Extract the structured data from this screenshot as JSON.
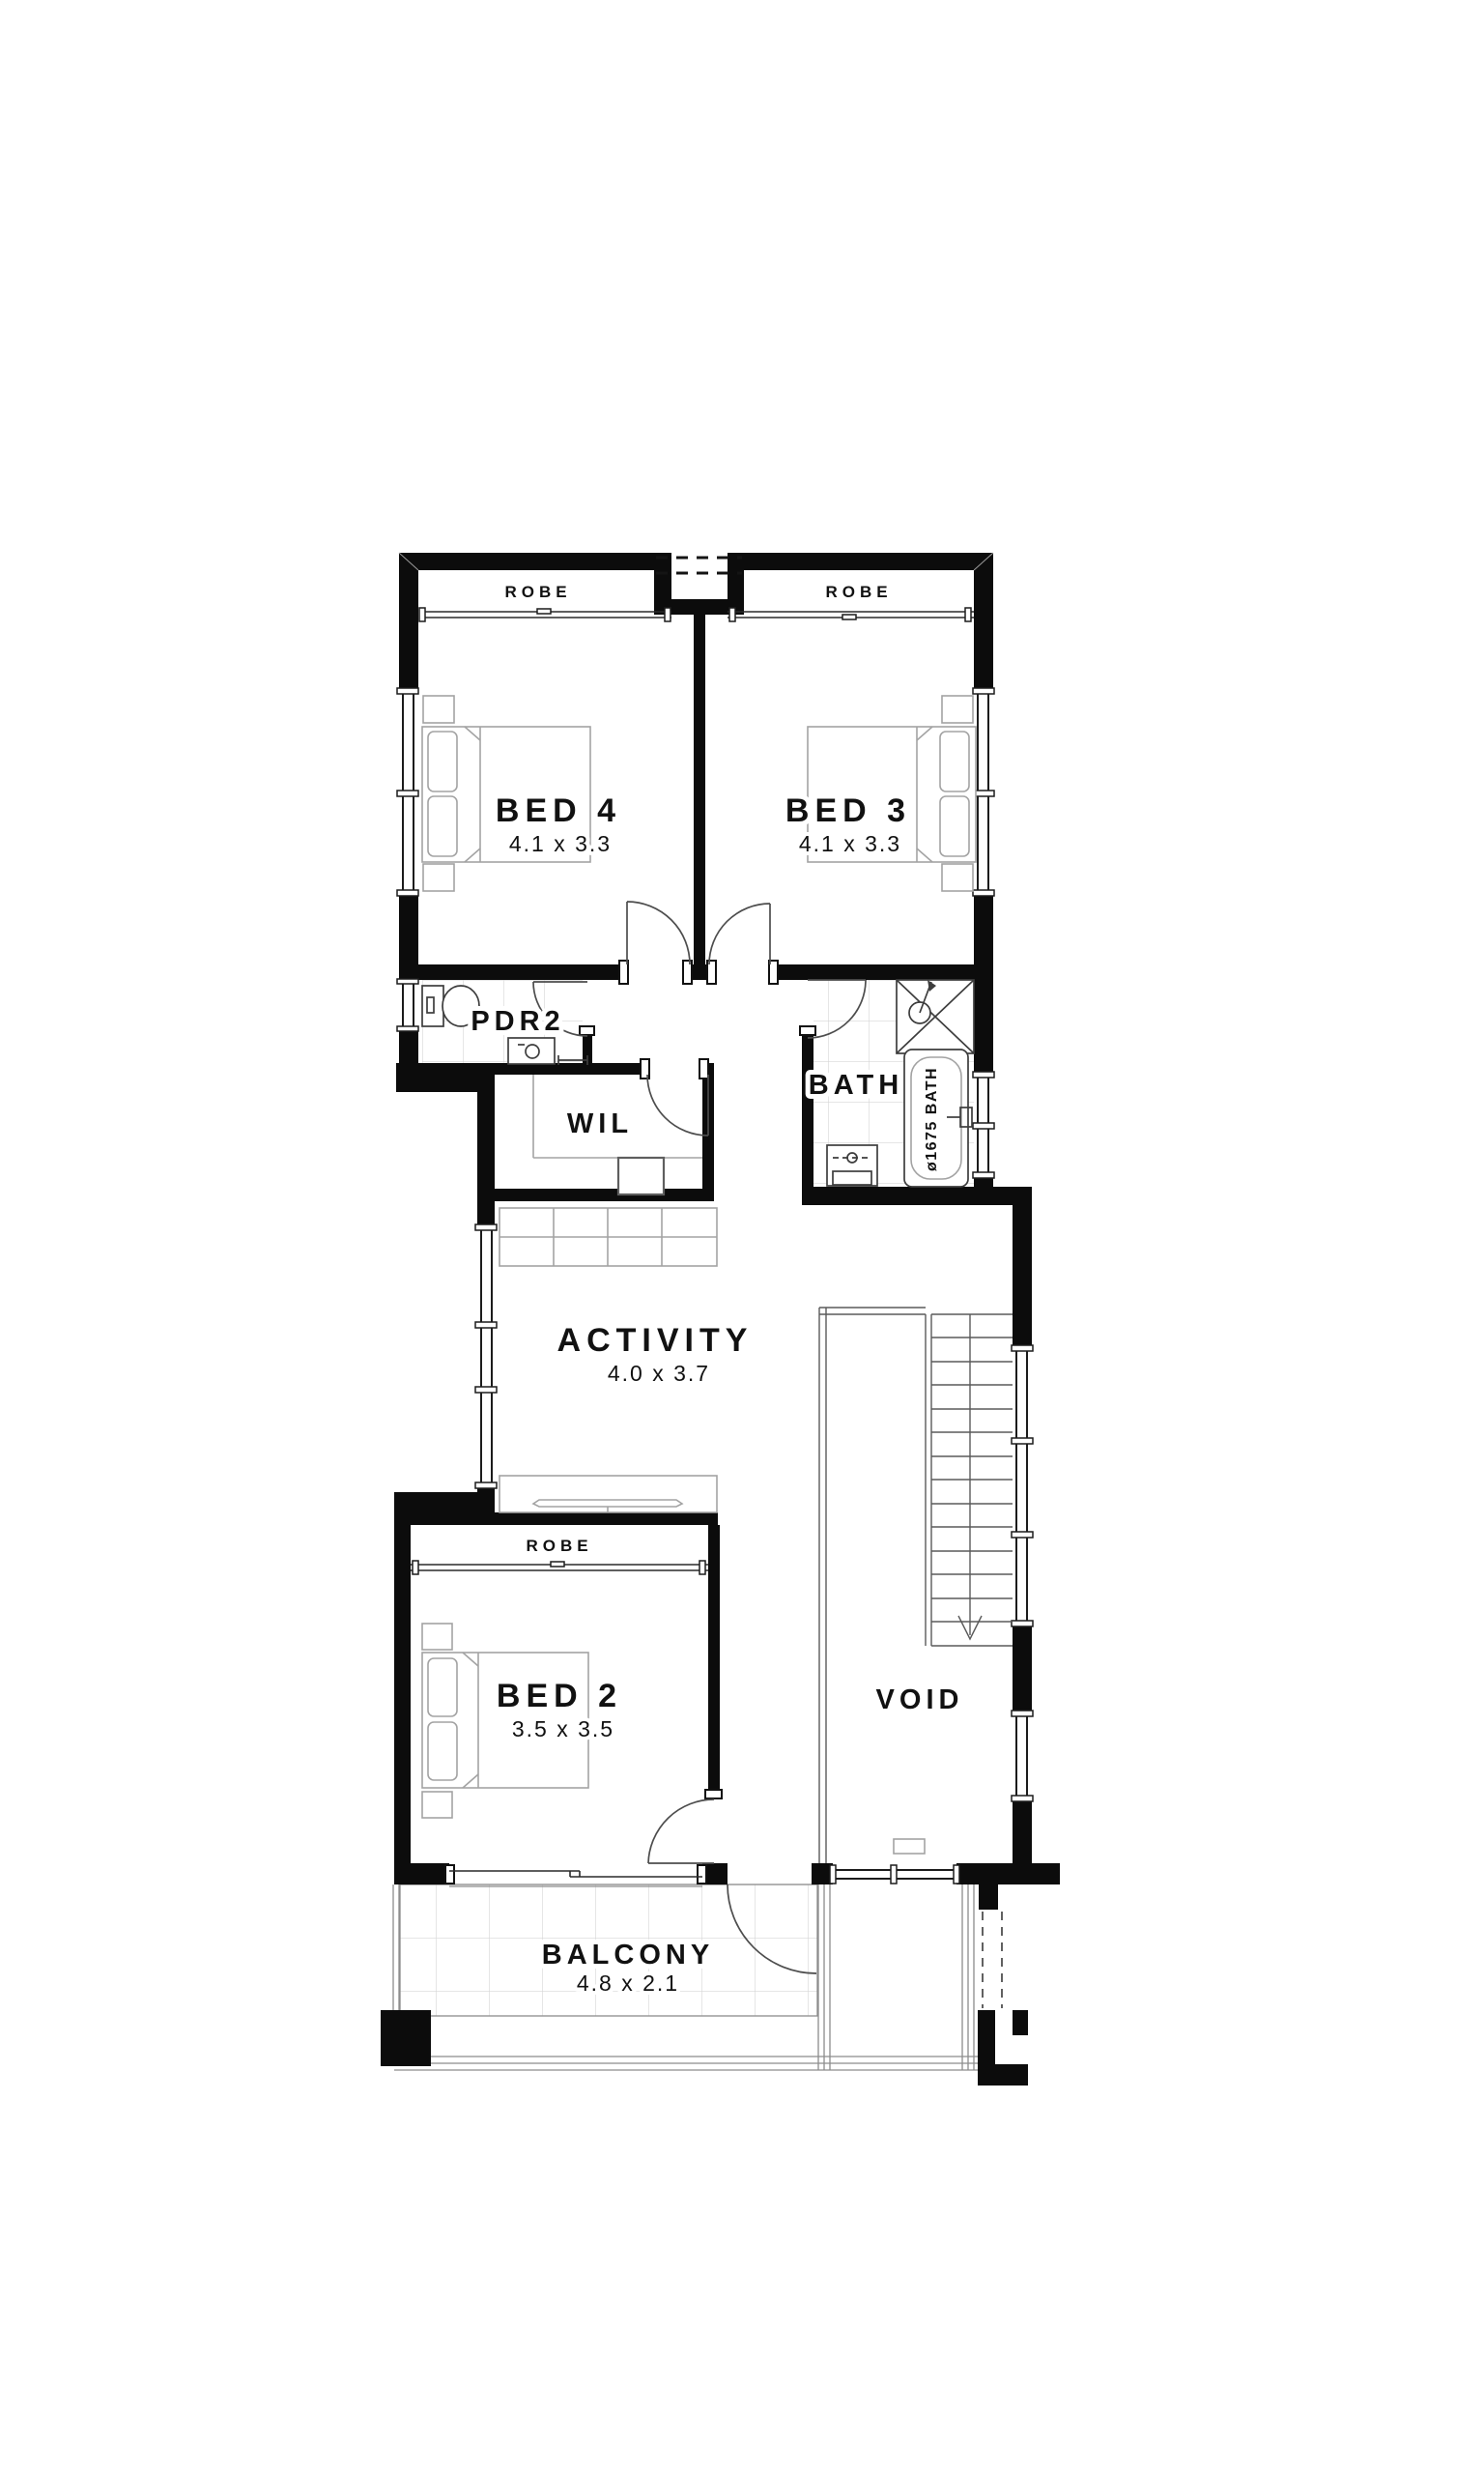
{
  "plan": {
    "type": "floor-plan",
    "rooms": {
      "bed4": {
        "name": "BED 4",
        "dims": "4.1 x 3.3"
      },
      "bed3": {
        "name": "BED 3",
        "dims": "4.1 x 3.3"
      },
      "bed2": {
        "name": "BED 2",
        "dims": "3.5 x 3.5"
      },
      "activity": {
        "name": "ACTIVITY",
        "dims": "4.0 x 3.7"
      },
      "balcony": {
        "name": "BALCONY",
        "dims": "4.8 x 2.1"
      },
      "bath": {
        "name": "BATH"
      },
      "pdr2": {
        "name": "PDR2"
      },
      "wil": {
        "name": "WIL"
      },
      "void": {
        "name": "VOID"
      },
      "robe_bed4": {
        "name": "ROBE"
      },
      "robe_bed3": {
        "name": "ROBE"
      },
      "robe_bed2": {
        "name": "ROBE"
      }
    },
    "fixtures": {
      "bath_tub_label": "ø1675 BATH"
    },
    "colors": {
      "wall": "#0c0c0c",
      "background": "#ffffff",
      "furniture_line": "#a3a3a3",
      "fixture_line": "#3d3d3d",
      "tile_line": "#d6d6d6",
      "text": "#111111"
    }
  }
}
